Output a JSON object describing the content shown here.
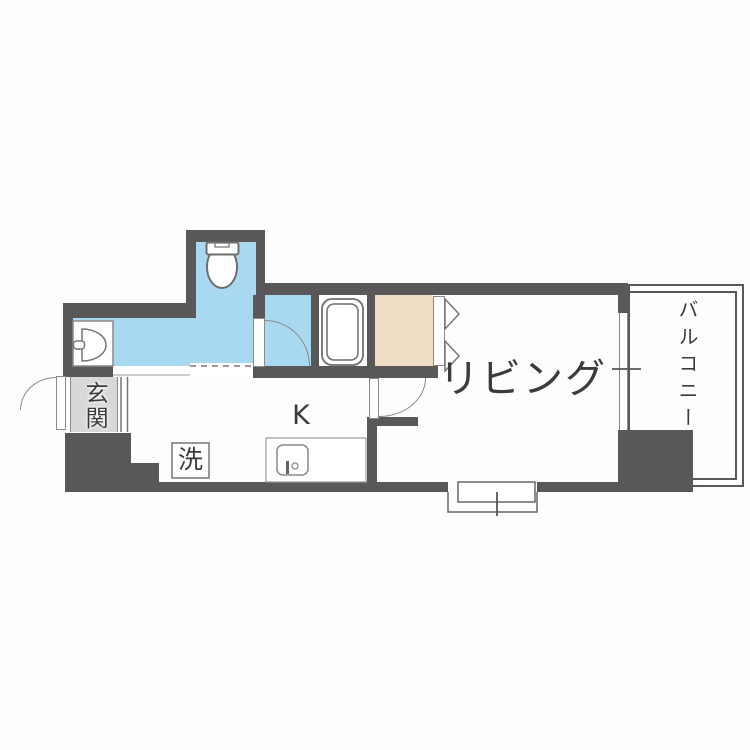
{
  "floorplan": {
    "title": "1K apartment floor plan",
    "rooms": {
      "entrance_label": "玄関",
      "kitchen_label": "K",
      "living_label": "リビング",
      "balcony_label": "バルコニー",
      "washer_label": "洗"
    },
    "fixtures": {
      "toilet": "toilet-icon",
      "washbasin": "washbasin-icon",
      "bathtub": "bathtub-icon",
      "kitchen_sink": "kitchen-sink-icon",
      "washing_machine_space": "washing-machine-box",
      "closet_doors": "folding-door-triangles",
      "swing_doors": "door-swing-arc",
      "windows": "window-symbol",
      "balcony_railing": "railing-double-line"
    },
    "colors": {
      "wall": "#595757",
      "water_area": "#a9d9f1",
      "closet": "#efdcc4",
      "entrance_floor": "#d8d8d8",
      "background": "#fdfdfd"
    }
  }
}
